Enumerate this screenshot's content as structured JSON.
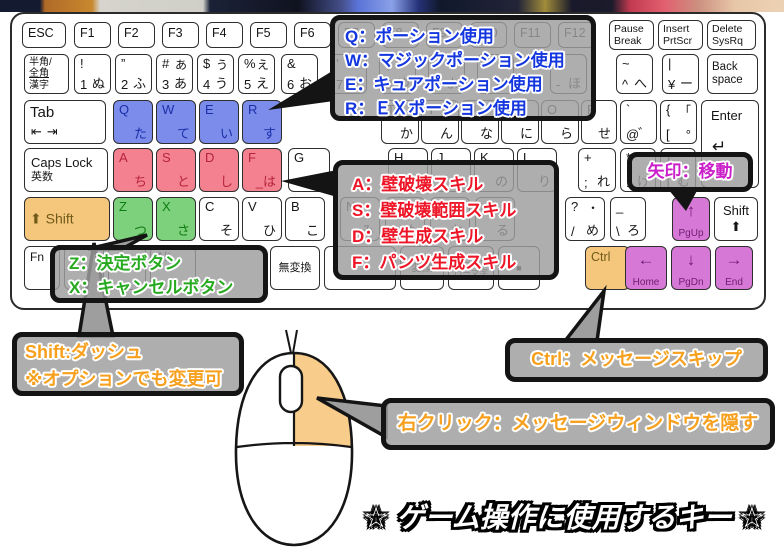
{
  "title": "☆ ゲーム操作に使用するキー ☆",
  "colors": {
    "blue_key": "#7b8ceb",
    "pink_key": "#f4818f",
    "green_key": "#7ed17c",
    "orange_key": "#f5c77d",
    "purple_key": "#d678d6",
    "potion_text": "#1436df",
    "skill_text": "#ee1526",
    "confirm_text": "#27aa20",
    "move_text": "#cb1fc9",
    "action_text": "#f7a01e",
    "title_text": "#ffffff",
    "callout_bg_gray": "#9e9e9e"
  },
  "callouts": {
    "potions": {
      "lines": [
        "Q：ポーション使用",
        "W：マジックポーション使用",
        "E：キュアポーション使用",
        "R：ＥＸポーション使用"
      ]
    },
    "skills": {
      "lines": [
        "A：壁破壊スキル",
        "S：壁破壊範囲スキル",
        "D：壁生成スキル",
        "F：パンツ生成スキル"
      ]
    },
    "confirm": {
      "lines": [
        "Z：決定ボタン",
        "X：キャンセルボタン"
      ]
    },
    "move": {
      "lines": [
        "矢印：移動"
      ]
    },
    "dash": {
      "lines": [
        "Shift:ダッシュ",
        "※オプションでも変更可"
      ]
    },
    "skip": {
      "lines": [
        "Ctrl：メッセージスキップ"
      ]
    },
    "rightclick": {
      "lines": [
        "右クリック：メッセージウィンドウを隠す"
      ]
    }
  },
  "keyboard": {
    "keys": [
      {
        "id": "esc",
        "main": "ESC"
      },
      {
        "id": "f1",
        "main": "F1"
      },
      {
        "id": "f2",
        "main": "F2"
      },
      {
        "id": "f3",
        "main": "F3"
      },
      {
        "id": "f4",
        "main": "F4"
      },
      {
        "id": "f5",
        "main": "F5"
      },
      {
        "id": "f6",
        "main": "F6"
      },
      {
        "id": "f7",
        "main": "F7"
      },
      {
        "id": "f8",
        "main": "F8"
      },
      {
        "id": "f9",
        "main": "F9"
      },
      {
        "id": "f10",
        "main": "F10"
      },
      {
        "id": "f11",
        "main": "F11"
      },
      {
        "id": "f12",
        "main": "F12"
      },
      {
        "id": "pause",
        "lines": [
          "Pause",
          "Break"
        ]
      },
      {
        "id": "insert",
        "lines": [
          "Insert",
          "PrtScr"
        ]
      },
      {
        "id": "delete",
        "lines": [
          "Delete",
          "SysRq"
        ]
      },
      {
        "id": "hankaku",
        "lines": [
          "半角/",
          "全角",
          "漢字"
        ]
      },
      {
        "id": "k1",
        "tl": "!",
        "bl": "1",
        "br": "ぬ"
      },
      {
        "id": "k2",
        "tl": "”",
        "bl": "2",
        "br": "ふ"
      },
      {
        "id": "k3",
        "tl": "#",
        "tr": "あ",
        "bl": "3",
        "br": "あ"
      },
      {
        "id": "k4",
        "tl": "$",
        "tr": "う",
        "bl": "4",
        "br": "う"
      },
      {
        "id": "k5",
        "tl": "%",
        "tr": "え",
        "bl": "5",
        "br": "え"
      },
      {
        "id": "k6",
        "tl": "&",
        "bl": "6",
        "br": "お"
      },
      {
        "id": "k7",
        "tl": "’",
        "bl": "7",
        "br": "や"
      },
      {
        "id": "k8",
        "tl": "(",
        "bl": "8",
        "br": "ゆ"
      },
      {
        "id": "k9",
        "tl": ")",
        "bl": "9",
        "br": "よ"
      },
      {
        "id": "k0",
        "bl": "0",
        "br": "わ"
      },
      {
        "id": "minus",
        "bl": "-",
        "br": "ほ"
      },
      {
        "id": "caret",
        "tl": "~",
        "bl": "^",
        "br": "へ"
      },
      {
        "id": "yen",
        "tl": "|",
        "bl": "¥",
        "br": "ー"
      },
      {
        "id": "backspace",
        "lines": [
          "Back",
          "space"
        ]
      },
      {
        "id": "tab",
        "main": "Tab",
        "sub": "⇤⇥"
      },
      {
        "id": "q",
        "tl": "Q",
        "br": "た",
        "color": "blue"
      },
      {
        "id": "w",
        "tl": "W",
        "br": "て",
        "color": "blue"
      },
      {
        "id": "e",
        "tl": "E",
        "br": "い",
        "color": "blue"
      },
      {
        "id": "r",
        "tl": "R",
        "br": "す",
        "color": "blue"
      },
      {
        "id": "t",
        "tl": "T",
        "br": "か"
      },
      {
        "id": "y",
        "tl": "Y",
        "br": "ん"
      },
      {
        "id": "u",
        "tl": "U",
        "br": "な"
      },
      {
        "id": "i",
        "tl": "I",
        "br": "に"
      },
      {
        "id": "o",
        "tl": "O",
        "br": "ら"
      },
      {
        "id": "p",
        "tl": "P",
        "br": "せ"
      },
      {
        "id": "at",
        "tl": "`",
        "bl": "@",
        "br": "゛"
      },
      {
        "id": "lbracket",
        "tl": "{",
        "tr": "「",
        "bl": "[",
        "br": "°"
      },
      {
        "id": "enter",
        "main": "Enter",
        "sub": "↵"
      },
      {
        "id": "caps",
        "lines": [
          "Caps Lock",
          "英数"
        ]
      },
      {
        "id": "a",
        "tl": "A",
        "br": "ち",
        "color": "pink"
      },
      {
        "id": "s",
        "tl": "S",
        "br": "と",
        "color": "pink"
      },
      {
        "id": "d",
        "tl": "D",
        "br": "し",
        "color": "pink"
      },
      {
        "id": "f",
        "tl": "F",
        "br": "_は",
        "color": "pink"
      },
      {
        "id": "g",
        "tl": "G",
        "br": "き"
      },
      {
        "id": "h",
        "tl": "H",
        "br": "く"
      },
      {
        "id": "j",
        "tl": "J",
        "br": "ま"
      },
      {
        "id": "k",
        "tl": "K",
        "br": "の"
      },
      {
        "id": "l",
        "tl": "L",
        "br": "り"
      },
      {
        "id": "semicolon",
        "tl": "+",
        "bl": ";",
        "br": "れ"
      },
      {
        "id": "colon",
        "tl": "*",
        "bl": ":",
        "br": "け"
      },
      {
        "id": "rbracket",
        "tl": "}",
        "bl": "]",
        "br": "む"
      },
      {
        "id": "shiftl",
        "main": "⬆ Shift",
        "color": "orange"
      },
      {
        "id": "z",
        "tl": "Z",
        "br": "つ",
        "color": "green"
      },
      {
        "id": "x",
        "tl": "X",
        "br": "さ",
        "color": "green"
      },
      {
        "id": "c",
        "tl": "C",
        "br": "そ"
      },
      {
        "id": "v",
        "tl": "V",
        "br": "ひ"
      },
      {
        "id": "b",
        "tl": "B",
        "br": "こ"
      },
      {
        "id": "n",
        "tl": "N",
        "br": "み"
      },
      {
        "id": "m",
        "tl": "M",
        "br": "も"
      },
      {
        "id": "comma",
        "tl": "<",
        "tr": "、",
        "bl": ",",
        "br": "ね"
      },
      {
        "id": "period",
        "tl": ">",
        "tr": "。",
        "bl": ".",
        "br": "る"
      },
      {
        "id": "slash",
        "tl": "?",
        "tr": "・",
        "bl": "/",
        "br": "め"
      },
      {
        "id": "backslash",
        "tl": "_",
        "bl": "\\",
        "br": "ろ"
      },
      {
        "id": "pgup",
        "big": "↑",
        "sub2": "PgUp",
        "color": "purple"
      },
      {
        "id": "shiftr",
        "lines": [
          "Shift",
          "⬆"
        ]
      },
      {
        "id": "fn",
        "main": "Fn"
      },
      {
        "id": "bk1"
      },
      {
        "id": "bk2"
      },
      {
        "id": "alt",
        "main": "Alt"
      },
      {
        "id": "muhenkan",
        "lines": [
          "無変換"
        ]
      },
      {
        "id": "space"
      },
      {
        "id": "henkan",
        "lines": [
          "変換"
        ]
      },
      {
        "id": "hiragana",
        "lines": [
          "ひらがな",
          "ローマ字"
        ]
      },
      {
        "id": "menu",
        "lines": [
          "■"
        ]
      },
      {
        "id": "ctrl",
        "main": "Ctrl",
        "color": "orange"
      },
      {
        "id": "home",
        "big": "←",
        "sub2": "Home",
        "color": "purple"
      },
      {
        "id": "pgdn",
        "big": "↓",
        "sub2": "PgDn",
        "color": "purple"
      },
      {
        "id": "end",
        "big": "→",
        "sub2": "End",
        "color": "purple"
      }
    ]
  }
}
